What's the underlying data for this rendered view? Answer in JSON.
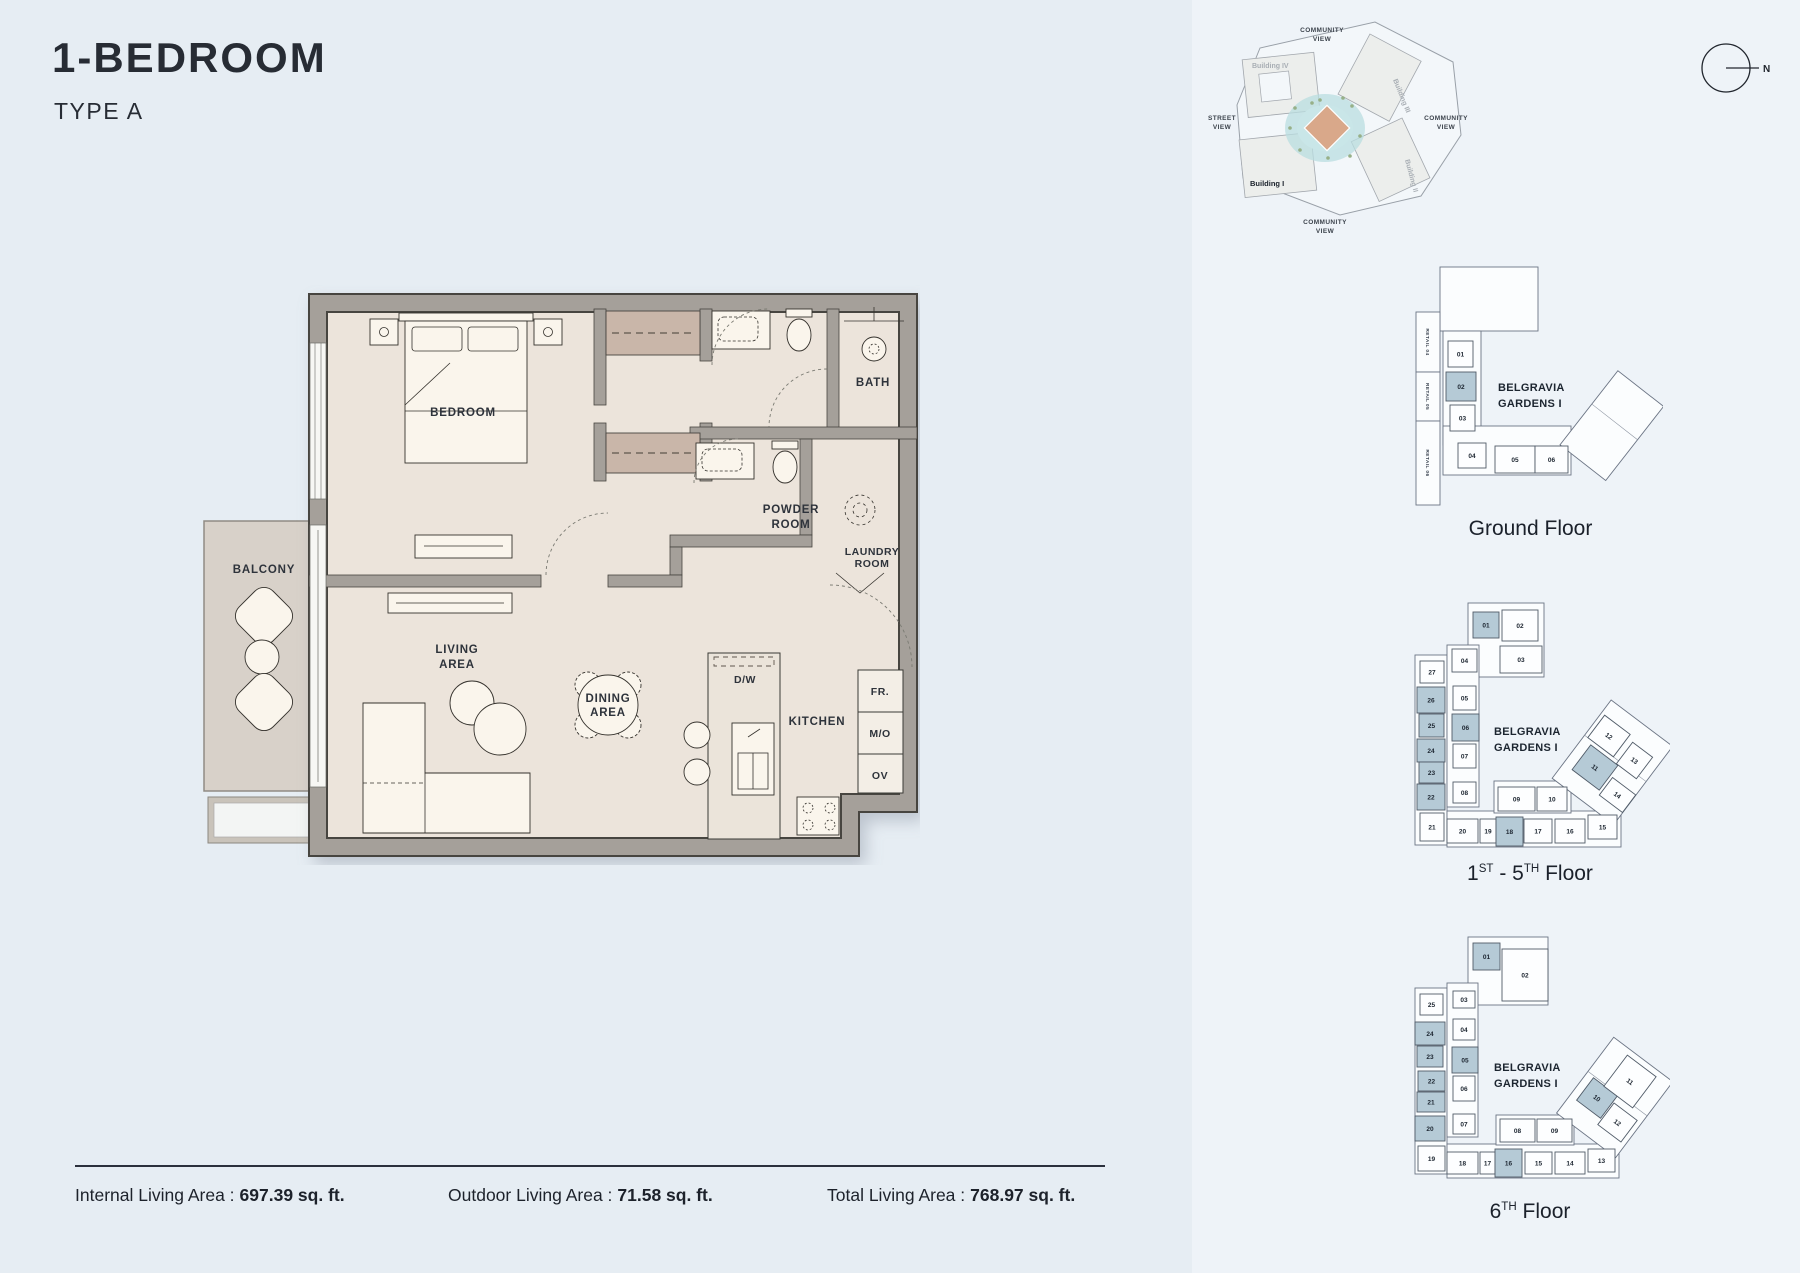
{
  "page": {
    "title": "1-BEDROOM",
    "subtitle": "TYPE A"
  },
  "colors": {
    "highlight": "#b5cad6",
    "wall": "#a5a09a",
    "floor": "#ece4db",
    "balcony_floor": "#d8d1c9",
    "closet": "#c9b6a9",
    "pond": "#b9dde0",
    "diamond": "#d9a88a"
  },
  "floorplan": {
    "labels": {
      "bedroom": "BEDROOM",
      "bath": "BATH",
      "powder1": "POWDER",
      "powder2": "ROOM",
      "laundry1": "LAUNDRY",
      "laundry2": "ROOM",
      "balcony": "BALCONY",
      "living1": "LIVING",
      "living2": "AREA",
      "dining1": "DINING",
      "dining2": "AREA",
      "kitchen": "KITCHEN",
      "dw": "D/W",
      "fr": "FR.",
      "mo": "M/O",
      "ov": "OV"
    }
  },
  "stats": {
    "items": [
      {
        "label": "Internal Living Area :",
        "value": "697.39 sq. ft."
      },
      {
        "label": "Outdoor Living Area :",
        "value": "71.58 sq. ft."
      },
      {
        "label": "Total Living Area :",
        "value": "768.97 sq. ft."
      }
    ]
  },
  "siteplan": {
    "compass_label": "N",
    "view_word1": "COMMUNITY",
    "view_word2": "VIEW",
    "street_word1": "STREET",
    "street_word2": "VIEW",
    "buildings": {
      "b1": "Building I",
      "b2": "Building II",
      "b3": "Building III",
      "b4": "Building IV"
    }
  },
  "keyplans": [
    {
      "caption": "Ground Floor",
      "caption_parts": [
        {
          "t": "Ground Floor"
        }
      ],
      "building": [
        "BELGRAVIA",
        "GARDENS I"
      ],
      "label_x": 100,
      "label_y": 136,
      "footprint": [
        {
          "x": 42,
          "y": 12,
          "w": 98,
          "h": 64
        },
        {
          "x": 45,
          "y": 76,
          "w": 38,
          "h": 114
        },
        {
          "x": 45,
          "y": 171,
          "w": 128,
          "h": 49
        }
      ],
      "wing": {
        "x": 185,
        "y": 123,
        "w": 58,
        "h": 94,
        "rot": 38,
        "cx": 213,
        "cy": 170
      },
      "retail": [
        {
          "t": "RETAIL 04",
          "x": 18,
          "y": 57,
          "w": 24,
          "h": 60
        },
        {
          "t": "RETAIL 05",
          "x": 18,
          "y": 117,
          "w": 24,
          "h": 49
        },
        {
          "t": "RETAIL 06",
          "x": 18,
          "y": 166,
          "w": 24,
          "h": 84
        }
      ],
      "units": [
        {
          "n": "01",
          "x": 50,
          "y": 86,
          "w": 25,
          "h": 26
        },
        {
          "n": "02",
          "x": 48,
          "y": 117,
          "w": 30,
          "h": 29,
          "hl": true
        },
        {
          "n": "03",
          "x": 52,
          "y": 150,
          "w": 25,
          "h": 26
        },
        {
          "n": "04",
          "x": 60,
          "y": 188,
          "w": 28,
          "h": 25
        },
        {
          "n": "05",
          "x": 97,
          "y": 191,
          "w": 40,
          "h": 27
        },
        {
          "n": "06",
          "x": 137,
          "y": 191,
          "w": 33,
          "h": 27
        }
      ]
    },
    {
      "caption": "1ST - 5TH Floor",
      "caption_parts": [
        {
          "t": "1"
        },
        {
          "t": "ST",
          "sup": true
        },
        {
          "t": " - 5"
        },
        {
          "t": "TH",
          "sup": true
        },
        {
          "t": " Floor"
        }
      ],
      "building": [
        "BELGRAVIA",
        "GARDENS I"
      ],
      "label_x": 104,
      "label_y": 150,
      "footprint": [
        {
          "x": 78,
          "y": 18,
          "w": 76,
          "h": 74
        },
        {
          "x": 25,
          "y": 70,
          "w": 32,
          "h": 190
        },
        {
          "x": 57,
          "y": 60,
          "w": 32,
          "h": 162
        },
        {
          "x": 57,
          "y": 226,
          "w": 174,
          "h": 36
        },
        {
          "x": 104,
          "y": 196,
          "w": 77,
          "h": 32
        }
      ],
      "wing": {
        "x": 184,
        "y": 128,
        "w": 77,
        "h": 98,
        "rot": 37,
        "cx": 222,
        "cy": 177
      },
      "retail": [],
      "units": [
        {
          "n": "01",
          "x": 83,
          "y": 27,
          "w": 26,
          "h": 26,
          "hl": true
        },
        {
          "n": "02",
          "x": 112,
          "y": 25,
          "w": 36,
          "h": 31
        },
        {
          "n": "03",
          "x": 110,
          "y": 61,
          "w": 42,
          "h": 27
        },
        {
          "n": "04",
          "x": 62,
          "y": 64,
          "w": 25,
          "h": 23
        },
        {
          "n": "05",
          "x": 63,
          "y": 101,
          "w": 23,
          "h": 24
        },
        {
          "n": "06",
          "x": 62,
          "y": 129,
          "w": 27,
          "h": 27,
          "hl": true
        },
        {
          "n": "07",
          "x": 63,
          "y": 159,
          "w": 23,
          "h": 24
        },
        {
          "n": "08",
          "x": 63,
          "y": 197,
          "w": 23,
          "h": 21
        },
        {
          "n": "27",
          "x": 30,
          "y": 76,
          "w": 24,
          "h": 22
        },
        {
          "n": "26",
          "x": 27,
          "y": 102,
          "w": 28,
          "h": 26,
          "hl": true
        },
        {
          "n": "25",
          "x": 29,
          "y": 129,
          "w": 25,
          "h": 23,
          "hl": true
        },
        {
          "n": "24",
          "x": 27,
          "y": 154,
          "w": 28,
          "h": 23,
          "hl": true
        },
        {
          "n": "23",
          "x": 29,
          "y": 177,
          "w": 25,
          "h": 21,
          "hl": true
        },
        {
          "n": "22",
          "x": 27,
          "y": 199,
          "w": 28,
          "h": 26,
          "hl": true
        },
        {
          "n": "21",
          "x": 30,
          "y": 228,
          "w": 24,
          "h": 28
        },
        {
          "n": "20",
          "x": 57,
          "y": 234,
          "w": 31,
          "h": 24
        },
        {
          "n": "19",
          "x": 90,
          "y": 234,
          "w": 16,
          "h": 24
        },
        {
          "n": "18",
          "x": 106,
          "y": 232,
          "w": 27,
          "h": 29,
          "hl": true
        },
        {
          "n": "17",
          "x": 134,
          "y": 234,
          "w": 28,
          "h": 24
        },
        {
          "n": "16",
          "x": 165,
          "y": 234,
          "w": 30,
          "h": 24
        },
        {
          "n": "15",
          "x": 198,
          "y": 230,
          "w": 29,
          "h": 24
        },
        {
          "n": "09",
          "x": 108,
          "y": 202,
          "w": 37,
          "h": 24
        },
        {
          "n": "10",
          "x": 147,
          "y": 202,
          "w": 30,
          "h": 24
        },
        {
          "n": "11",
          "x": 188,
          "y": 167,
          "w": 34,
          "h": 31,
          "hl": true,
          "rot": 37
        },
        {
          "n": "12",
          "x": 203,
          "y": 137,
          "w": 32,
          "h": 28,
          "rot": 37
        },
        {
          "n": "13",
          "x": 232,
          "y": 162,
          "w": 25,
          "h": 27,
          "rot": 37
        },
        {
          "n": "14",
          "x": 213,
          "y": 199,
          "w": 29,
          "h": 22,
          "rot": 37
        }
      ]
    },
    {
      "caption": "6TH Floor",
      "caption_parts": [
        {
          "t": "6"
        },
        {
          "t": "TH",
          "sup": true
        },
        {
          "t": " Floor"
        }
      ],
      "building": [
        "BELGRAVIA",
        "GARDENS I"
      ],
      "label_x": 104,
      "label_y": 146,
      "footprint": [
        {
          "x": 78,
          "y": 12,
          "w": 80,
          "h": 68
        },
        {
          "x": 25,
          "y": 63,
          "w": 32,
          "h": 186
        },
        {
          "x": 57,
          "y": 58,
          "w": 31,
          "h": 154
        },
        {
          "x": 57,
          "y": 219,
          "w": 172,
          "h": 34
        },
        {
          "x": 106,
          "y": 190,
          "w": 78,
          "h": 30
        }
      ],
      "wing": {
        "x": 188,
        "y": 125,
        "w": 74,
        "h": 95,
        "rot": 37,
        "cx": 225,
        "cy": 172
      },
      "retail": [],
      "units": [
        {
          "n": "01",
          "x": 83,
          "y": 18,
          "w": 27,
          "h": 27,
          "hl": true
        },
        {
          "n": "02",
          "x": 112,
          "y": 24,
          "w": 46,
          "h": 52
        },
        {
          "n": "03",
          "x": 63,
          "y": 66,
          "w": 22,
          "h": 17
        },
        {
          "n": "04",
          "x": 63,
          "y": 94,
          "w": 22,
          "h": 21
        },
        {
          "n": "05",
          "x": 62,
          "y": 122,
          "w": 26,
          "h": 26,
          "hl": true
        },
        {
          "n": "06",
          "x": 63,
          "y": 151,
          "w": 22,
          "h": 25
        },
        {
          "n": "07",
          "x": 63,
          "y": 189,
          "w": 22,
          "h": 20
        },
        {
          "n": "25",
          "x": 30,
          "y": 69,
          "w": 23,
          "h": 21
        },
        {
          "n": "24",
          "x": 25,
          "y": 97,
          "w": 30,
          "h": 23,
          "hl": true
        },
        {
          "n": "23",
          "x": 27,
          "y": 121,
          "w": 26,
          "h": 21,
          "hl": true
        },
        {
          "n": "22",
          "x": 28,
          "y": 146,
          "w": 27,
          "h": 20,
          "hl": true
        },
        {
          "n": "21",
          "x": 27,
          "y": 167,
          "w": 28,
          "h": 20,
          "hl": true
        },
        {
          "n": "20",
          "x": 25,
          "y": 191,
          "w": 30,
          "h": 25,
          "hl": true
        },
        {
          "n": "19",
          "x": 28,
          "y": 221,
          "w": 27,
          "h": 25
        },
        {
          "n": "18",
          "x": 57,
          "y": 227,
          "w": 31,
          "h": 22
        },
        {
          "n": "17",
          "x": 90,
          "y": 227,
          "w": 15,
          "h": 22
        },
        {
          "n": "16",
          "x": 105,
          "y": 224,
          "w": 27,
          "h": 28,
          "hl": true
        },
        {
          "n": "15",
          "x": 135,
          "y": 227,
          "w": 27,
          "h": 22
        },
        {
          "n": "14",
          "x": 165,
          "y": 227,
          "w": 30,
          "h": 22
        },
        {
          "n": "13",
          "x": 198,
          "y": 224,
          "w": 27,
          "h": 23
        },
        {
          "n": "08",
          "x": 110,
          "y": 194,
          "w": 35,
          "h": 23
        },
        {
          "n": "09",
          "x": 147,
          "y": 194,
          "w": 35,
          "h": 23
        },
        {
          "n": "10",
          "x": 192,
          "y": 159,
          "w": 30,
          "h": 28,
          "hl": true,
          "rot": 37
        },
        {
          "n": "11",
          "x": 222,
          "y": 137,
          "w": 36,
          "h": 39,
          "rot": 37
        },
        {
          "n": "12",
          "x": 213,
          "y": 184,
          "w": 29,
          "h": 27,
          "rot": 37
        }
      ]
    }
  ]
}
